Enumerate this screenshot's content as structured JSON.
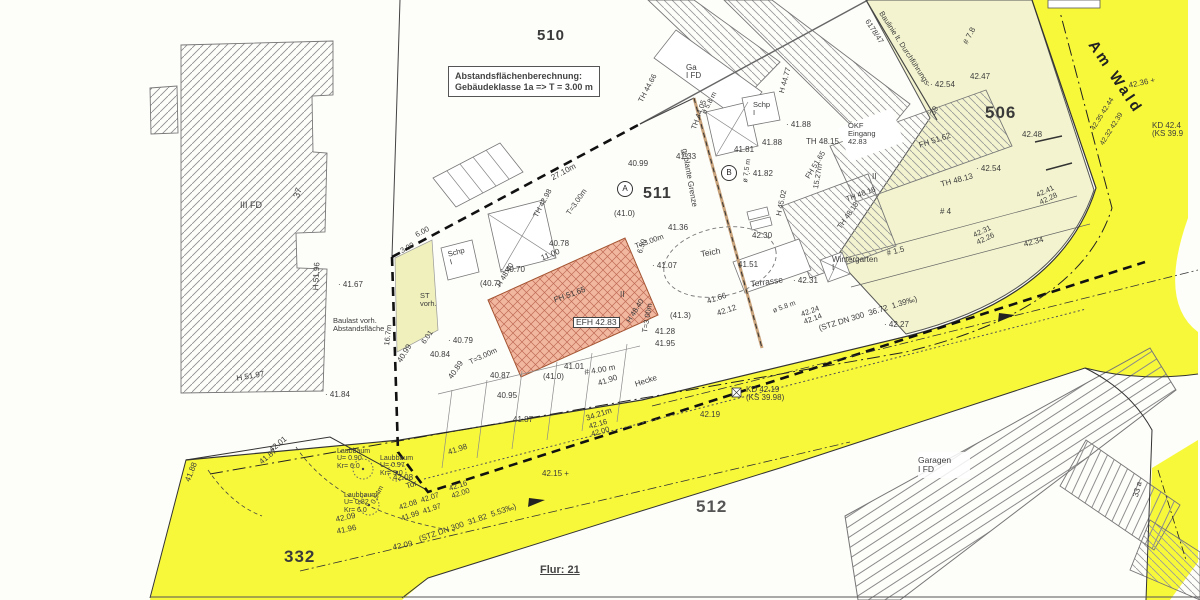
{
  "title_box": {
    "line1": "Abstandsflächenberechnung:",
    "line2": "Gebäudeklasse 1a => T = 3.00 m"
  },
  "street": {
    "name": "Am Wald"
  },
  "parcels": {
    "p510": "510",
    "p511": "511",
    "p506": "506",
    "p512": "512",
    "p332": "332",
    "flur": "Flur: 21"
  },
  "markers": {
    "circle_a": "A",
    "circle_b": "B"
  },
  "colors": {
    "road_yellow": "#f8f83a",
    "parcel_cream": "#f3f4cf",
    "building_pink": "#f1b79f",
    "hatch_gray": "#909090",
    "boundary_dark": "#222222",
    "planned_boundary_tan": "#c8a27a"
  },
  "labels": [
    {
      "n": "building-iii-fd",
      "t": "III FD",
      "x": 240,
      "y": 201,
      "r": 0,
      "s": 9
    },
    {
      "n": "house-number-37",
      "t": "37",
      "x": 292,
      "y": 196,
      "r": -70,
      "s": 9
    },
    {
      "n": "height-h5196",
      "t": "H 51.96",
      "x": 312,
      "y": 290,
      "r": -87,
      "s": 8
    },
    {
      "n": "height-h5197",
      "t": "H 51.97",
      "x": 236,
      "y": 375,
      "r": -10,
      "s": 8
    },
    {
      "n": "elev-4167",
      "t": "· 41.67",
      "x": 338,
      "y": 281,
      "r": 0,
      "s": 8
    },
    {
      "n": "elev-4184",
      "t": "· 41.84",
      "x": 325,
      "y": 391,
      "r": 0,
      "s": 8
    },
    {
      "n": "baulast-note",
      "t": "Baulast vorh.\nAbstandsfläche",
      "x": 333,
      "y": 317,
      "r": 0,
      "s": 7.5
    },
    {
      "n": "dim-167m",
      "t": "16.7m",
      "x": 383,
      "y": 345,
      "r": -83,
      "s": 7.5
    },
    {
      "n": "st-vorh-note",
      "t": "ST\nvorh.",
      "x": 420,
      "y": 292,
      "r": 0,
      "s": 7.5
    },
    {
      "n": "dim-300",
      "t": "3.00",
      "x": 399,
      "y": 248,
      "r": -28,
      "s": 7.5
    },
    {
      "n": "dim-600",
      "t": "6.00",
      "x": 414,
      "y": 232,
      "r": -28,
      "s": 7.5
    },
    {
      "n": "dim-2710m",
      "t": "27.10m",
      "x": 550,
      "y": 175,
      "r": -28,
      "s": 8
    },
    {
      "n": "elev-4099-top",
      "t": "40.99",
      "x": 628,
      "y": 160,
      "r": 0,
      "s": 8
    },
    {
      "n": "elev-4133",
      "t": "41.33",
      "x": 676,
      "y": 153,
      "r": 0,
      "s": 8
    },
    {
      "n": "height-th4466",
      "t": "TH 44.66",
      "x": 637,
      "y": 100,
      "r": -62,
      "s": 7.5
    },
    {
      "n": "height-th4405",
      "t": "TH 44.05",
      "x": 690,
      "y": 128,
      "r": -70,
      "s": 7.5
    },
    {
      "n": "dia-58m-top",
      "t": "ø 5.8 m",
      "x": 701,
      "y": 112,
      "r": -62,
      "s": 7
    },
    {
      "n": "building-schp-top",
      "t": "Schp\nI",
      "x": 753,
      "y": 101,
      "r": 0,
      "s": 7.5
    },
    {
      "n": "height-h4477",
      "t": "H 44.77",
      "x": 778,
      "y": 92,
      "r": -75,
      "s": 7.5
    },
    {
      "n": "elev-4188-a",
      "t": "· 41.88",
      "x": 786,
      "y": 121,
      "r": 0,
      "s": 8
    },
    {
      "n": "elev-4188-b",
      "t": "41.88",
      "x": 762,
      "y": 139,
      "r": 0,
      "s": 8
    },
    {
      "n": "height-th4815",
      "t": "TH 48.15",
      "x": 806,
      "y": 138,
      "r": 0,
      "s": 8
    },
    {
      "n": "elev-4181",
      "t": "41.81",
      "x": 734,
      "y": 146,
      "r": 0,
      "s": 8
    },
    {
      "n": "elev-4182",
      "t": "· 41.82",
      "x": 748,
      "y": 170,
      "r": 0,
      "s": 8
    },
    {
      "n": "dia-75m",
      "t": "ø 7.5 m",
      "x": 742,
      "y": 182,
      "r": -82,
      "s": 7
    },
    {
      "n": "planned-boundary-label",
      "t": "geplante Grenze",
      "x": 688,
      "y": 148,
      "r": 80,
      "s": 8
    },
    {
      "n": "building-ga-fd",
      "t": "Ga\nI FD",
      "x": 686,
      "y": 64,
      "r": 0,
      "s": 8
    },
    {
      "n": "elev-4099-left",
      "t": "40.99",
      "x": 396,
      "y": 360,
      "r": -58,
      "s": 8
    },
    {
      "n": "elev-4078",
      "t": "40.78",
      "x": 549,
      "y": 240,
      "r": 0,
      "s": 8
    },
    {
      "n": "height-th4298",
      "t": "TH 42.98",
      "x": 532,
      "y": 215,
      "r": -62,
      "s": 7.5
    },
    {
      "n": "dim-1100",
      "t": "11.00",
      "x": 540,
      "y": 255,
      "r": -22,
      "s": 8
    },
    {
      "n": "elev-4070",
      "t": "· 40.70",
      "x": 500,
      "y": 266,
      "r": 0,
      "s": 8
    },
    {
      "n": "elev-407-paren",
      "t": "(40.7)",
      "x": 480,
      "y": 280,
      "r": 0,
      "s": 8
    },
    {
      "n": "height-h4840-a",
      "t": "H 48.40",
      "x": 495,
      "y": 284,
      "r": -58,
      "s": 7.5
    },
    {
      "n": "height-fh5165-bldg",
      "t": "FH 51.65",
      "x": 553,
      "y": 297,
      "r": -20,
      "s": 8
    },
    {
      "n": "efh-label",
      "t": "EFH 42.83",
      "x": 573,
      "y": 317,
      "r": 0,
      "s": 8.5,
      "cls": "box"
    },
    {
      "n": "storeys-ii-efh",
      "t": "II",
      "x": 620,
      "y": 291,
      "r": 0,
      "s": 8
    },
    {
      "n": "height-h4840-b",
      "t": "H 48.40",
      "x": 625,
      "y": 320,
      "r": -58,
      "s": 7.5
    },
    {
      "n": "elev-413-paren",
      "t": "(41.3)",
      "x": 670,
      "y": 312,
      "r": 0,
      "s": 8
    },
    {
      "n": "elev-4128",
      "t": "41.28",
      "x": 655,
      "y": 328,
      "r": 0,
      "s": 8
    },
    {
      "n": "elev-4195",
      "t": "41.95",
      "x": 655,
      "y": 340,
      "r": 0,
      "s": 8
    },
    {
      "n": "dim-t300-a",
      "t": "T=3.00m",
      "x": 565,
      "y": 212,
      "r": -55,
      "s": 7.5
    },
    {
      "n": "dim-t300-b",
      "t": "T=3.00m",
      "x": 634,
      "y": 243,
      "r": -20,
      "s": 7.5
    },
    {
      "n": "dim-t300-c",
      "t": "T=3.00m",
      "x": 468,
      "y": 359,
      "r": -25,
      "s": 7.5
    },
    {
      "n": "dim-t300-d",
      "t": "T=3.00m",
      "x": 641,
      "y": 332,
      "r": -80,
      "s": 7.5
    },
    {
      "n": "dim-650",
      "t": "6.50",
      "x": 636,
      "y": 252,
      "r": -72,
      "s": 7.5
    },
    {
      "n": "elev-4136",
      "t": "41.36",
      "x": 668,
      "y": 224,
      "r": 0,
      "s": 8
    },
    {
      "n": "elev-4107",
      "t": "· 41.07",
      "x": 652,
      "y": 262,
      "r": 0,
      "s": 8
    },
    {
      "n": "elev-4079",
      "t": "· 40.79",
      "x": 448,
      "y": 337,
      "r": 0,
      "s": 8
    },
    {
      "n": "dim-601",
      "t": "6.01",
      "x": 420,
      "y": 341,
      "r": -55,
      "s": 7.5
    },
    {
      "n": "elev-4084",
      "t": "40.84",
      "x": 430,
      "y": 351,
      "r": 0,
      "s": 8
    },
    {
      "n": "elev-4087",
      "t": "40.87",
      "x": 490,
      "y": 372,
      "r": 0,
      "s": 8
    },
    {
      "n": "elev-4089",
      "t": "40.89",
      "x": 447,
      "y": 376,
      "r": -55,
      "s": 8
    },
    {
      "n": "elev-4095",
      "t": "40.95",
      "x": 497,
      "y": 392,
      "r": 0,
      "s": 8
    },
    {
      "n": "elev-410-paren-b",
      "t": "(41.0)",
      "x": 543,
      "y": 373,
      "r": 0,
      "s": 8
    },
    {
      "n": "elev-410-paren-a",
      "t": "(41.0)",
      "x": 614,
      "y": 210,
      "r": 0,
      "s": 8
    },
    {
      "n": "elev-4101",
      "t": "41.01",
      "x": 564,
      "y": 363,
      "r": 0,
      "s": 8
    },
    {
      "n": "dim-400m",
      "t": "# 4.00 m",
      "x": 584,
      "y": 369,
      "r": -10,
      "s": 8
    },
    {
      "n": "elev-4190",
      "t": "41.90",
      "x": 597,
      "y": 380,
      "r": -18,
      "s": 8
    },
    {
      "n": "elev-4187-a",
      "t": "41.87",
      "x": 513,
      "y": 416,
      "r": 0,
      "s": 8
    },
    {
      "n": "dim-3421m",
      "t": "34.21m",
      "x": 585,
      "y": 415,
      "r": -18,
      "s": 8
    },
    {
      "n": "hecke-label",
      "t": "Hecke",
      "x": 634,
      "y": 381,
      "r": -18,
      "s": 8
    },
    {
      "n": "elev-pair-4216-b",
      "t": "42.16\n42.00",
      "x": 588,
      "y": 423,
      "r": -16,
      "s": 7.5
    },
    {
      "n": "manhole-kd4219",
      "t": "KD 42.19\n(KS 39.98)",
      "x": 746,
      "y": 386,
      "r": 0,
      "s": 8
    },
    {
      "n": "elev-4219",
      "t": "42.19",
      "x": 700,
      "y": 411,
      "r": 0,
      "s": 8
    },
    {
      "n": "elev-4215",
      "t": "42.15 +",
      "x": 542,
      "y": 470,
      "r": 0,
      "s": 8
    },
    {
      "n": "sewer-text-south",
      "t": "(STZ DN 300  31.82  5.53‰)",
      "x": 418,
      "y": 536,
      "r": -19,
      "s": 8
    },
    {
      "n": "sewer-text-north",
      "t": "(STZ DN 300  36.72  1.39‰)",
      "x": 818,
      "y": 325,
      "r": -17,
      "s": 8
    },
    {
      "n": "elev-4227",
      "t": "· 42.27",
      "x": 884,
      "y": 321,
      "r": 0,
      "s": 8
    },
    {
      "n": "elev-pair-4224",
      "t": "42.24\n42.14",
      "x": 800,
      "y": 311,
      "r": -20,
      "s": 7.5
    },
    {
      "n": "tor-label",
      "t": "Tor",
      "x": 405,
      "y": 483,
      "r": -18,
      "s": 8
    },
    {
      "n": "elev-4208",
      "t": "42.08",
      "x": 393,
      "y": 474,
      "r": 0,
      "s": 8
    },
    {
      "n": "elev-pair-4208-4207",
      "t": "42.08  42.07",
      "x": 398,
      "y": 504,
      "r": -18,
      "s": 7.5
    },
    {
      "n": "elev-pair-4199-4197",
      "t": "41.99  41.97",
      "x": 400,
      "y": 515,
      "r": -18,
      "s": 7.5
    },
    {
      "n": "elev-pair-4216-a",
      "t": "42.16\n42.00",
      "x": 448,
      "y": 485,
      "r": -18,
      "s": 7.5
    },
    {
      "n": "dim-054m",
      "t": "0.54m",
      "x": 370,
      "y": 502,
      "r": -62,
      "s": 7
    },
    {
      "n": "tree-laubbaum-1",
      "t": "Laubbaum\nU= 0.90\nKr= 6.0",
      "x": 337,
      "y": 448,
      "r": 0,
      "s": 7
    },
    {
      "n": "tree-laubbaum-2",
      "t": "Laubbaum\nU= 0.97\nKr= 5.0",
      "x": 380,
      "y": 455,
      "r": 0,
      "s": 7
    },
    {
      "n": "tree-laubbaum-3",
      "t": "Laubbaum\nU= 0.82\nKr= 6.0",
      "x": 344,
      "y": 492,
      "r": 0,
      "s": 7
    },
    {
      "n": "elev-4198",
      "t": "41.98",
      "x": 447,
      "y": 449,
      "r": -18,
      "s": 8
    },
    {
      "n": "elev-4209-a",
      "t": "42.09",
      "x": 335,
      "y": 516,
      "r": -12,
      "s": 8
    },
    {
      "n": "elev-4196-a",
      "t": "41.96",
      "x": 336,
      "y": 528,
      "r": -12,
      "s": 8
    },
    {
      "n": "elev-4209-b",
      "t": "42.09",
      "x": 392,
      "y": 544,
      "r": -12,
      "s": 8
    },
    {
      "n": "elev-4201",
      "t": "42.01",
      "x": 268,
      "y": 448,
      "r": -40,
      "s": 8
    },
    {
      "n": "elev-4187-b",
      "t": "41.87",
      "x": 258,
      "y": 460,
      "r": -40,
      "s": 8
    },
    {
      "n": "elev-4188-c",
      "t": "41.88",
      "x": 184,
      "y": 480,
      "r": -68,
      "s": 8
    },
    {
      "n": "teich-label",
      "t": "Teich",
      "x": 700,
      "y": 250,
      "r": -10,
      "s": 8.5
    },
    {
      "n": "elev-4151",
      "t": "41.51",
      "x": 738,
      "y": 261,
      "r": 0,
      "s": 8
    },
    {
      "n": "elev-4230",
      "t": "42.30",
      "x": 752,
      "y": 232,
      "r": 0,
      "s": 8
    },
    {
      "n": "terrasse-label",
      "t": "Terrasse",
      "x": 750,
      "y": 280,
      "r": -8,
      "s": 8.5
    },
    {
      "n": "elev-4231",
      "t": "· 42.31",
      "x": 793,
      "y": 277,
      "r": 0,
      "s": 8
    },
    {
      "n": "height-h4502",
      "t": "H 45.02",
      "x": 775,
      "y": 215,
      "r": -78,
      "s": 7.5
    },
    {
      "n": "elev-4166",
      "t": "41.66",
      "x": 706,
      "y": 298,
      "r": -18,
      "s": 8
    },
    {
      "n": "elev-4212",
      "t": "42.12",
      "x": 716,
      "y": 310,
      "r": -18,
      "s": 8
    },
    {
      "n": "dia-58m-south",
      "t": "ø 5.8 m",
      "x": 772,
      "y": 308,
      "r": -20,
      "s": 7
    },
    {
      "n": "dim-1527m",
      "t": "15.27m",
      "x": 812,
      "y": 188,
      "r": -80,
      "s": 7.5
    },
    {
      "n": "height-fh5165-right",
      "t": "FH 51.65",
      "x": 804,
      "y": 176,
      "r": -58,
      "s": 7.5
    },
    {
      "n": "height-th4816",
      "t": "TH 48.16",
      "x": 845,
      "y": 196,
      "r": -20,
      "s": 7.5
    },
    {
      "n": "okf-eingang",
      "t": "ÖKF\nEingang\n42.83",
      "x": 848,
      "y": 122,
      "r": 0,
      "s": 7.5
    },
    {
      "n": "height-fh5162",
      "t": "FH 51.62",
      "x": 918,
      "y": 142,
      "r": -18,
      "s": 8
    },
    {
      "n": "house-number-39",
      "t": "39",
      "x": 929,
      "y": 113,
      "r": -62,
      "s": 8
    },
    {
      "n": "storeys-ii-right",
      "t": "II",
      "x": 872,
      "y": 173,
      "r": 0,
      "s": 8
    },
    {
      "n": "height-th4813",
      "t": "TH 48.13",
      "x": 940,
      "y": 181,
      "r": -15,
      "s": 8
    },
    {
      "n": "house-number-4",
      "t": "# 4",
      "x": 940,
      "y": 208,
      "r": 0,
      "s": 8
    },
    {
      "n": "height-th4818",
      "t": "TH 48.18",
      "x": 836,
      "y": 226,
      "r": -55,
      "s": 7.5
    },
    {
      "n": "dim-15",
      "t": "# 1.5",
      "x": 886,
      "y": 250,
      "r": -15,
      "s": 8
    },
    {
      "n": "wintergarten-label",
      "t": "Wintergarten\nI",
      "x": 832,
      "y": 256,
      "r": 0,
      "s": 8
    },
    {
      "n": "elev-4254-a",
      "t": "· 42.54",
      "x": 930,
      "y": 81,
      "r": 0,
      "s": 8
    },
    {
      "n": "elev-4247",
      "t": "42.47",
      "x": 970,
      "y": 73,
      "r": 0,
      "s": 8
    },
    {
      "n": "dim-78",
      "t": "# 7.8",
      "x": 962,
      "y": 42,
      "r": -62,
      "s": 8
    },
    {
      "n": "elev-4248",
      "t": "42.48",
      "x": 1022,
      "y": 131,
      "r": 0,
      "s": 8
    },
    {
      "n": "elev-4254-b",
      "t": "· 42.54",
      "x": 976,
      "y": 165,
      "r": 0,
      "s": 8
    },
    {
      "n": "elev-pair-4241-4228",
      "t": "42.41\n42.28",
      "x": 1035,
      "y": 192,
      "r": -25,
      "s": 7.5
    },
    {
      "n": "elev-pair-4231-4226",
      "t": "42.31\n42.26",
      "x": 972,
      "y": 232,
      "r": -25,
      "s": 7.5
    },
    {
      "n": "elev-4234",
      "t": "42.34",
      "x": 1023,
      "y": 241,
      "r": -15,
      "s": 8
    },
    {
      "n": "elev-4236",
      "t": "42.36 +",
      "x": 1128,
      "y": 82,
      "r": -12,
      "s": 8
    },
    {
      "n": "manhole-kd424",
      "t": "KD 42.4\n(KS 39.9",
      "x": 1152,
      "y": 122,
      "r": 0,
      "s": 8
    },
    {
      "n": "elev-rot-4235-4244",
      "t": "42.35 42.44",
      "x": 1090,
      "y": 128,
      "r": -58,
      "s": 7
    },
    {
      "n": "elev-rot-4232-4239",
      "t": "42.32 42.39",
      "x": 1099,
      "y": 143,
      "r": -58,
      "s": 7
    },
    {
      "n": "baulinie-label",
      "t": "Baulinie lt. Durchführungs-",
      "x": 884,
      "y": 10,
      "r": 57,
      "s": 7.5
    },
    {
      "n": "baulinie-number",
      "t": "6178/47",
      "x": 870,
      "y": 18,
      "r": 57,
      "s": 7.5
    },
    {
      "n": "garagen-label",
      "t": "Garagen\nI FD",
      "x": 918,
      "y": 456,
      "r": 0,
      "s": 8.5
    },
    {
      "n": "house-number-33a",
      "t": "33 a",
      "x": 1132,
      "y": 496,
      "r": -75,
      "s": 8
    },
    {
      "n": "building-schp-left",
      "t": "Schp\nI",
      "x": 447,
      "y": 251,
      "r": -15,
      "s": 7.5
    }
  ]
}
